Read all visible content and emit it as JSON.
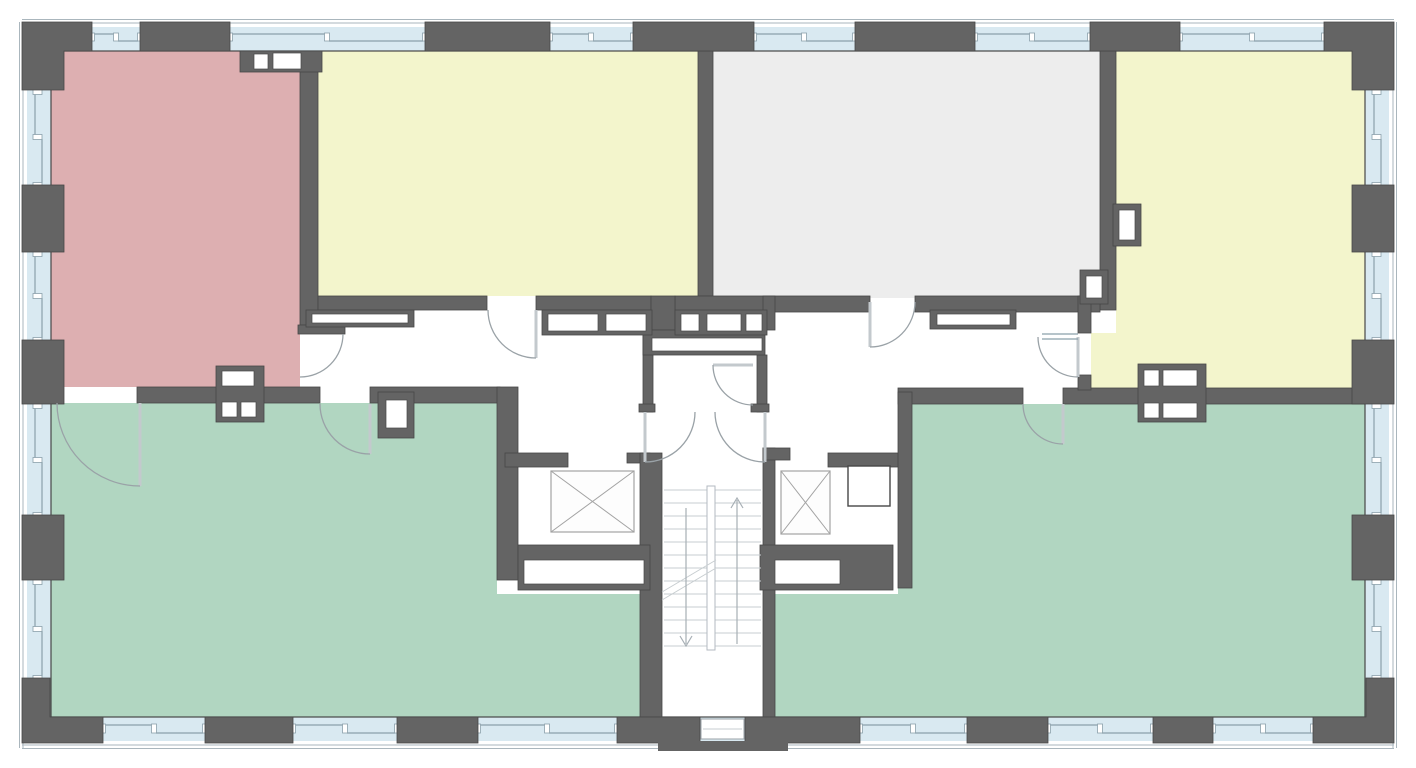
{
  "meta": {
    "kind": "architectural floor plan",
    "text_labels": "none",
    "description": "residential storey plan with two apartments around a central stair and elevator core"
  },
  "colors": {
    "wall": "#646464",
    "wall_outline": "#474747",
    "window_glass": "#d9e9f1",
    "window_frame": "#8ba0ab",
    "outer_hairline": "#aab6bd",
    "room_red": "#ddafb1",
    "room_yellow": "#f3f5cc",
    "room_gray": "#ededed",
    "room_green": "#b1d6c1",
    "floor_white": "#ffffff",
    "door_arc": "#9aa2a7",
    "door_leaf": "#c3c9cd",
    "stair_line": "#c7cdd0",
    "stair_stringer": "#b3bac0",
    "stair_arrow": "#a7afb5",
    "xbox_line": "#a3a3a3"
  },
  "rooms": [
    {
      "id": "room-top-left",
      "position": "top left",
      "fill_key": "room_red"
    },
    {
      "id": "room-top-center-left",
      "position": "top center-left",
      "fill_key": "room_yellow"
    },
    {
      "id": "room-top-center-right",
      "position": "top center-right",
      "fill_key": "room_gray"
    },
    {
      "id": "room-top-right",
      "position": "top right",
      "fill_key": "room_yellow"
    },
    {
      "id": "room-bottom-left",
      "position": "bottom left",
      "fill_key": "room_green"
    },
    {
      "id": "room-bottom-right",
      "position": "bottom right",
      "fill_key": "room_green"
    }
  ],
  "core": {
    "elevators": 2,
    "stair": "double-run stair with up and down direction arrows",
    "door_arcs": 10,
    "exterior": "continuous perimeter window band interrupted by wall piers",
    "shafts": "white duct/shaft boxes along corridor walls"
  }
}
